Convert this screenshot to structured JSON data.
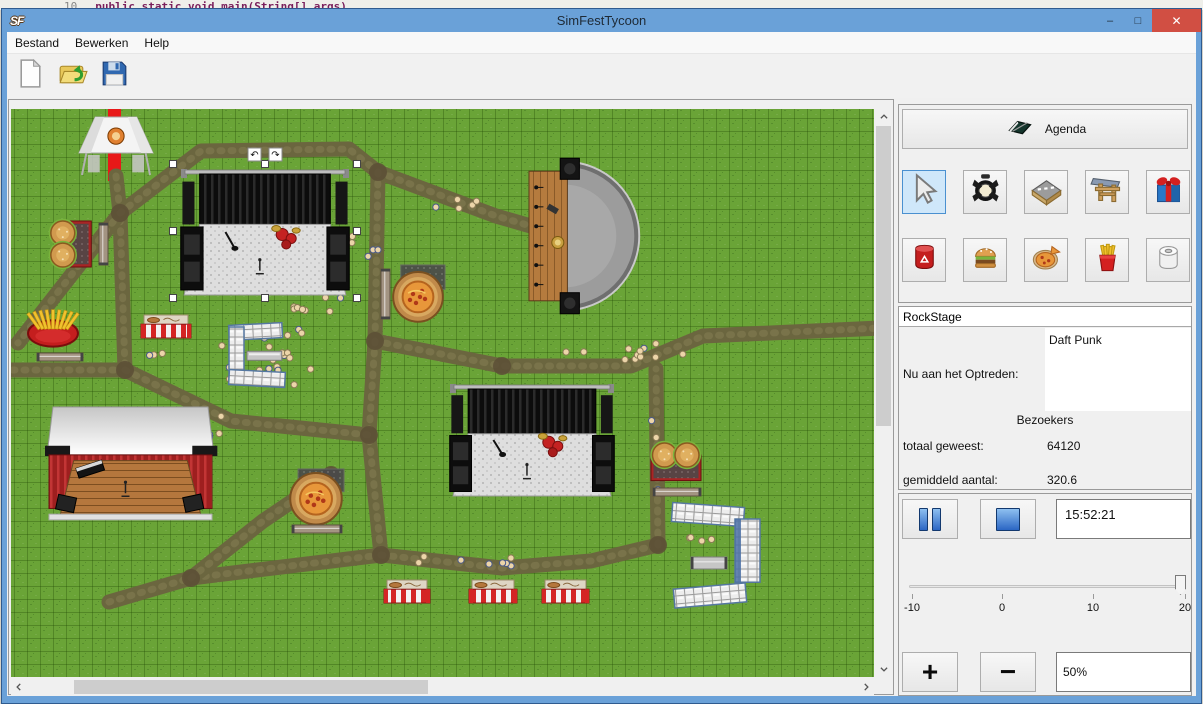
{
  "window": {
    "title": "SimFestTycoon",
    "icon_text": "SF",
    "minimize": "–",
    "maximize": "□",
    "close": "✕"
  },
  "background_strip": {
    "line_number": "10",
    "code": "public static void main(String[] args)"
  },
  "menu": {
    "items": [
      "Bestand",
      "Bewerken",
      "Help"
    ]
  },
  "toolbar": {
    "buttons": [
      {
        "icon": "new-document"
      },
      {
        "icon": "open-folder"
      },
      {
        "icon": "save-floppy"
      }
    ]
  },
  "sidebar": {
    "agenda": {
      "label": "Agenda",
      "icon": "agenda-book"
    },
    "tools": {
      "selected": "select-cursor",
      "row1": [
        "select-cursor",
        "spotlight",
        "road",
        "entrance-gate",
        "gift"
      ],
      "row2": [
        "trash-can",
        "burger",
        "pizza",
        "fries",
        "toilet-paper"
      ]
    },
    "stage_info": {
      "stage_name": "RockStage",
      "now_performing_label": "Nu aan het Optreden:",
      "now_performing": "Daft Punk",
      "visitors_header": "Bezoekers",
      "total_label": "totaal geweest:",
      "total_value": "64120",
      "average_label": "gemiddeld aantal:",
      "average_value": "320.6"
    },
    "playback": {
      "time": "15:52:21"
    },
    "speed_slider": {
      "min": -10,
      "max": 20,
      "value": 20,
      "ticks": [
        "-10",
        "0",
        "10",
        "20"
      ]
    },
    "zoom_controls": {
      "plus": "+",
      "minus": "−",
      "value": "50%"
    }
  },
  "map": {
    "colors": {
      "grass": "#6aa437",
      "path": "#6b663f",
      "gate_red": "#e81818"
    },
    "red_gate": {
      "x": 107,
      "y": 106,
      "w": 13,
      "h": 74
    },
    "segments": [
      [
        [
          115,
          175
        ],
        [
          119,
          212
        ],
        [
          124,
          369
        ]
      ],
      [
        [
          119,
          212
        ],
        [
          17,
          342
        ]
      ],
      [
        [
          124,
          369
        ],
        [
          10,
          369
        ]
      ],
      [
        [
          119,
          212
        ],
        [
          200,
          150
        ],
        [
          348,
          148
        ],
        [
          377,
          171
        ]
      ],
      [
        [
          377,
          171
        ],
        [
          495,
          215
        ],
        [
          547,
          230
        ]
      ],
      [
        [
          377,
          171
        ],
        [
          374,
          340
        ]
      ],
      [
        [
          374,
          340
        ],
        [
          501,
          365
        ],
        [
          630,
          365
        ],
        [
          702,
          335
        ],
        [
          880,
          327
        ]
      ],
      [
        [
          374,
          340
        ],
        [
          368,
          434
        ],
        [
          380,
          554
        ]
      ],
      [
        [
          380,
          554
        ],
        [
          190,
          577
        ],
        [
          108,
          601
        ]
      ],
      [
        [
          380,
          554
        ],
        [
          501,
          567
        ],
        [
          590,
          560
        ],
        [
          657,
          544
        ]
      ],
      [
        [
          657,
          544
        ],
        [
          655,
          368
        ]
      ],
      [
        [
          124,
          369
        ],
        [
          230,
          420
        ],
        [
          368,
          434
        ]
      ],
      [
        [
          190,
          577
        ],
        [
          262,
          520
        ],
        [
          330,
          474
        ]
      ]
    ],
    "junctions": [
      [
        119,
        212
      ],
      [
        124,
        369
      ],
      [
        374,
        340
      ],
      [
        377,
        171
      ],
      [
        368,
        434
      ],
      [
        380,
        554
      ],
      [
        190,
        577
      ],
      [
        657,
        544
      ],
      [
        501,
        365
      ],
      [
        330,
        474
      ]
    ],
    "crowd_clusters": [
      {
        "cx": 275,
        "cy": 352,
        "rx": 62,
        "ry": 46,
        "n": 34
      },
      {
        "cx": 310,
        "cy": 300,
        "rx": 42,
        "ry": 15,
        "n": 8
      },
      {
        "cx": 362,
        "cy": 246,
        "rx": 18,
        "ry": 16,
        "n": 5
      },
      {
        "cx": 465,
        "cy": 205,
        "rx": 35,
        "ry": 12,
        "n": 5
      },
      {
        "cx": 620,
        "cy": 352,
        "rx": 65,
        "ry": 16,
        "n": 12
      },
      {
        "cx": 655,
        "cy": 460,
        "rx": 10,
        "ry": 55,
        "n": 7
      },
      {
        "cx": 470,
        "cy": 562,
        "rx": 75,
        "ry": 12,
        "n": 8
      },
      {
        "cx": 550,
        "cy": 245,
        "rx": 22,
        "ry": 10,
        "n": 4
      },
      {
        "cx": 205,
        "cy": 430,
        "rx": 28,
        "ry": 22,
        "n": 6
      },
      {
        "cx": 150,
        "cy": 356,
        "rx": 14,
        "ry": 8,
        "n": 3
      },
      {
        "cx": 700,
        "cy": 540,
        "rx": 25,
        "ry": 12,
        "n": 4
      }
    ],
    "objects": [
      {
        "type": "tent",
        "x": 78,
        "y": 116,
        "w": 74,
        "h": 58
      },
      {
        "type": "burger-stand",
        "dir": "v",
        "x": 48,
        "y": 220,
        "w": 46,
        "h": 46
      },
      {
        "type": "bench-v",
        "x": 98,
        "y": 222,
        "w": 9,
        "h": 42
      },
      {
        "type": "fries-stand",
        "x": 26,
        "y": 306,
        "w": 52,
        "h": 44
      },
      {
        "type": "bench-h",
        "x": 36,
        "y": 352,
        "w": 46,
        "h": 8
      },
      {
        "type": "striped-stall",
        "x": 140,
        "y": 314,
        "w": 50,
        "h": 23
      },
      {
        "type": "barrier-c",
        "x": 228,
        "y": 323,
        "w": 56,
        "h": 62
      },
      {
        "type": "pizza-stand",
        "x": 390,
        "y": 264,
        "w": 54,
        "h": 58
      },
      {
        "type": "bench-v",
        "x": 380,
        "y": 268,
        "w": 9,
        "h": 50
      },
      {
        "type": "amphitheater",
        "x": 528,
        "y": 154,
        "w": 120,
        "h": 162
      },
      {
        "type": "dark-stage",
        "x": 178,
        "y": 168,
        "w": 172,
        "h": 126,
        "selected": true
      },
      {
        "type": "tent-stage",
        "x": 46,
        "y": 406,
        "w": 167,
        "h": 114
      },
      {
        "type": "pizza-stand",
        "x": 287,
        "y": 468,
        "w": 56,
        "h": 54
      },
      {
        "type": "bench-h",
        "x": 291,
        "y": 524,
        "w": 50,
        "h": 8
      },
      {
        "type": "dark-stage",
        "x": 447,
        "y": 383,
        "w": 168,
        "h": 112
      },
      {
        "type": "burger-stand",
        "dir": "h",
        "x": 650,
        "y": 442,
        "w": 50,
        "h": 40
      },
      {
        "type": "bench-h",
        "x": 652,
        "y": 487,
        "w": 48,
        "h": 8
      },
      {
        "type": "toilet-c",
        "x": 671,
        "y": 504,
        "w": 90,
        "h": 102
      },
      {
        "type": "bench-h",
        "metal": true,
        "x": 690,
        "y": 556,
        "w": 36,
        "h": 12
      },
      {
        "type": "striped-stall",
        "x": 383,
        "y": 579,
        "w": 46,
        "h": 23
      },
      {
        "type": "striped-stall",
        "x": 468,
        "y": 579,
        "w": 48,
        "h": 23
      },
      {
        "type": "striped-stall",
        "x": 541,
        "y": 579,
        "w": 47,
        "h": 23
      }
    ],
    "selection": {
      "x": 172,
      "y": 163,
      "w": 184,
      "h": 134
    }
  }
}
